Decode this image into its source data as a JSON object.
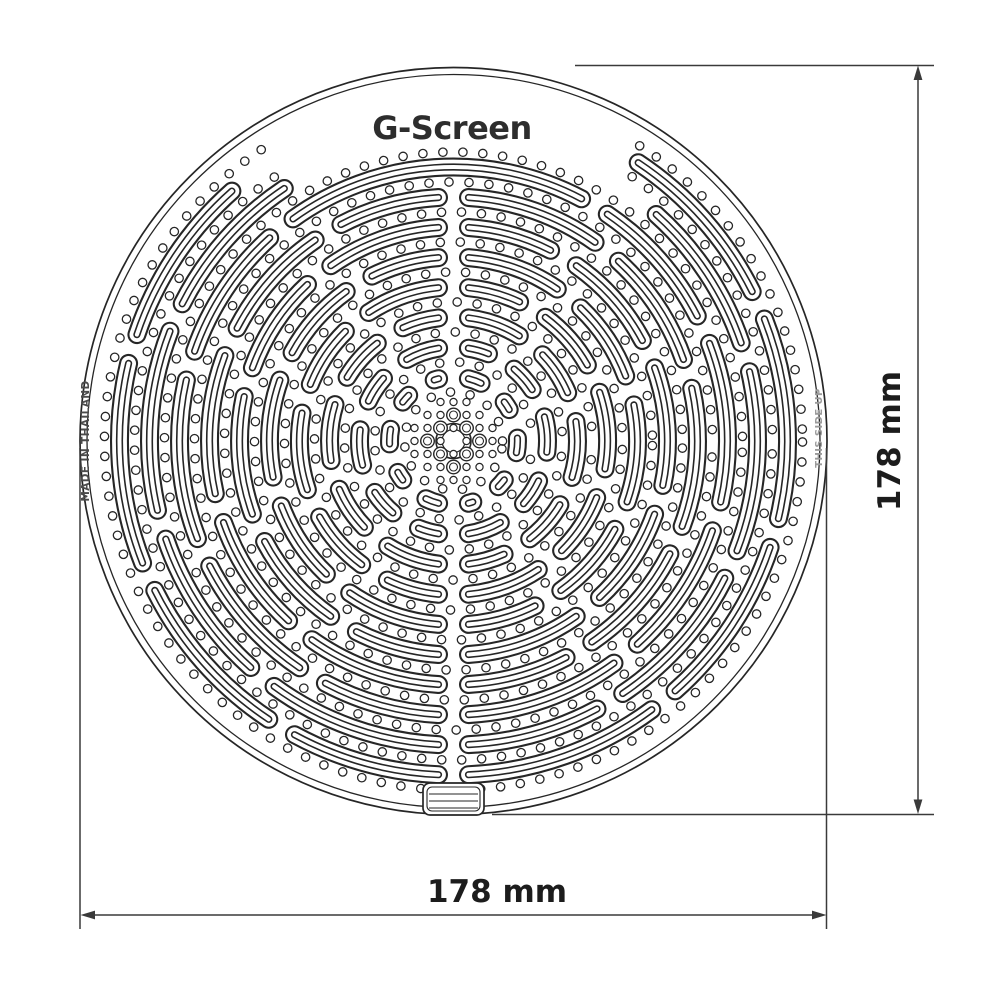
{
  "drawing": {
    "product_title": "G-Screen",
    "stamp_left": "MADE IN THAILAND",
    "stamp_right": "THIS SIDE UP",
    "dimension_width": {
      "label": "178 mm",
      "value_mm": 178
    },
    "dimension_height": {
      "label": "178 mm",
      "value_mm": 178
    },
    "colors": {
      "background": "#ffffff",
      "line": "#262626",
      "dim_line": "#3a3a3a",
      "title_text": "#2d2d2d",
      "dim_text": "#1c1c1c",
      "stamp_left_text": "#4b4b4b",
      "stamp_right_text": "#9b9b9b"
    },
    "pattern": {
      "center_x": 453.5,
      "center_y": 441,
      "outer_radius": 373.5,
      "inner_radius": 366.5,
      "clip_radius": 358,
      "ring_start": 64,
      "ring_step": 30,
      "ring_count": 10,
      "seam_angles_deg": [
        20,
        55,
        90,
        125,
        160,
        200,
        235,
        270,
        305,
        340
      ],
      "seam_stagger_deg": 4,
      "seam_trim_px": 15,
      "slot_widths": [
        19,
        14.8,
        7.2,
        4.0
      ],
      "dot_radius": 4.2,
      "dot_spacing_px": 20,
      "dot_ring_start": 49,
      "text_clear_min_r": 295,
      "text_clear_angles": [
        58,
        122
      ],
      "merged_top_ring_index": 7,
      "hub": {
        "grid_step": 13,
        "big_r_outer": 17.5,
        "big_r_inner": 11.5,
        "med_r_outer": 6.8,
        "med_r_inner": 4.0,
        "small_r": 3.6
      },
      "tab": {
        "x": 423,
        "y": 783,
        "width": 61,
        "height": 32,
        "corner": 7
      }
    }
  }
}
